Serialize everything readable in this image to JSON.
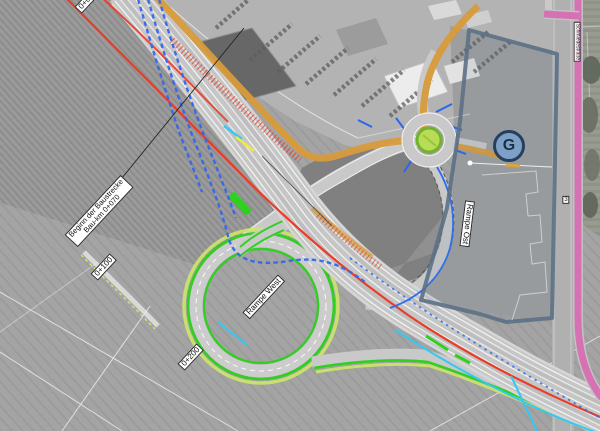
{
  "map": {
    "labels": {
      "construction_start_line1": "Beginn der Baustrecke",
      "construction_start_line2": "Bau-km 0+070",
      "station_top": "0+000",
      "station_100": "0+100",
      "station_200": "0+200",
      "ramp_west": "Rampe West",
      "ramp_east": "Rampe Ost",
      "area_marker": "G",
      "street_name": "Schmiedestraße",
      "parcel_marker": "3"
    },
    "legend_colors": {
      "existing_road_orange": "#d79b3c",
      "alignment_red": "#ea3c26",
      "drainage_blue": "#3567ee",
      "utility_cyan": "#35c8f2",
      "marking_yellow": "#f2ea3a",
      "new_edge_green": "#2fd01f",
      "verge_yellow_green": "#cde569",
      "boundary_slate": "#5c7086",
      "road_pink": "#d86bb2",
      "roundabout_island": "#b8dc55",
      "marker_fill": "#7fa0c6"
    }
  }
}
